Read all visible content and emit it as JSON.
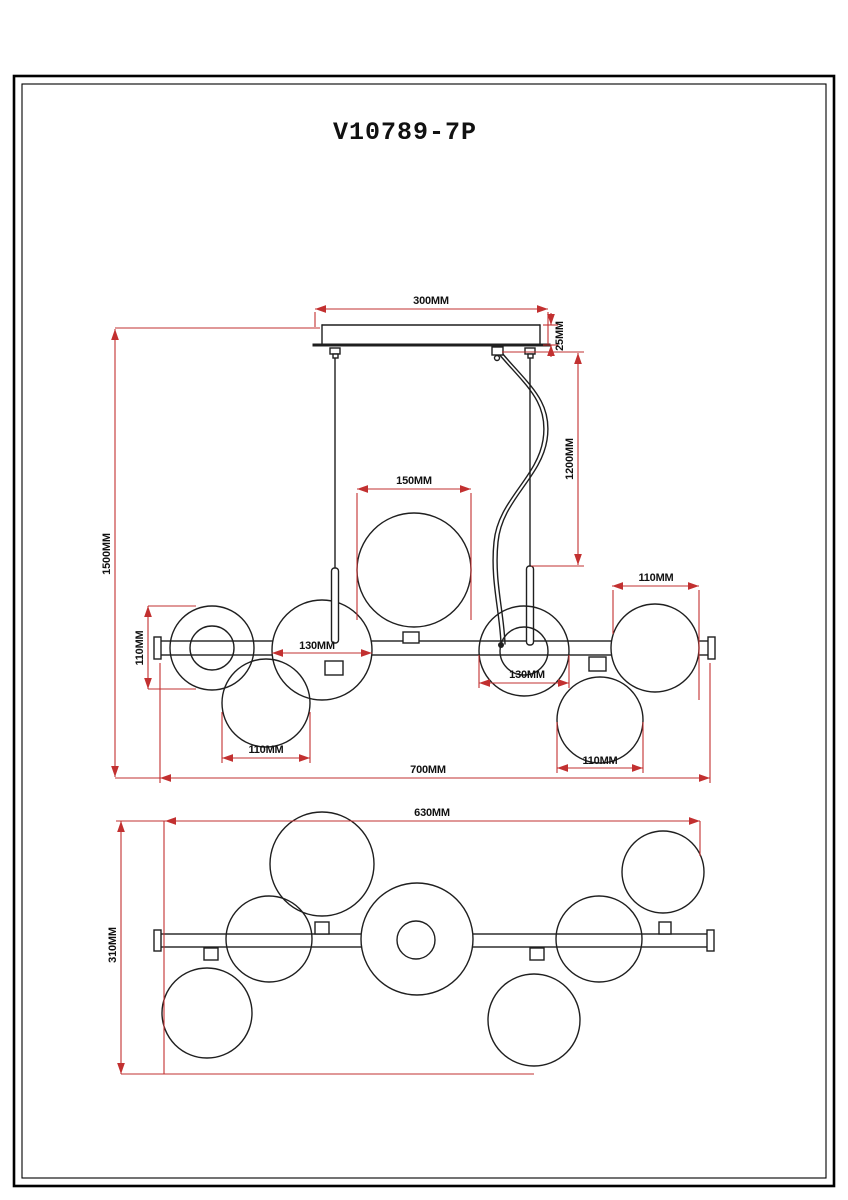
{
  "title": "V10789-7P",
  "colors": {
    "dimension_line": "#c23030",
    "drawing_line": "#1f1f1f",
    "background": "#ffffff",
    "frame": "#000000"
  },
  "dims": {
    "front": {
      "canopy_width": "300MM",
      "canopy_height": "25MM",
      "cord_drop": "1200MM",
      "overall_drop": "1500MM",
      "center_globe_dia": "150MM",
      "left_globe_dia": "110MM",
      "left_mid_globe_dia": "130MM",
      "right_mid_globe_dia": "130MM",
      "top_right_globe_dia": "110MM",
      "bottom_left_globe_dia": "110MM",
      "bottom_right_globe_dia": "110MM",
      "overall_width": "700MM"
    },
    "plan": {
      "inner_width": "630MM",
      "overall_depth": "310MM"
    }
  }
}
